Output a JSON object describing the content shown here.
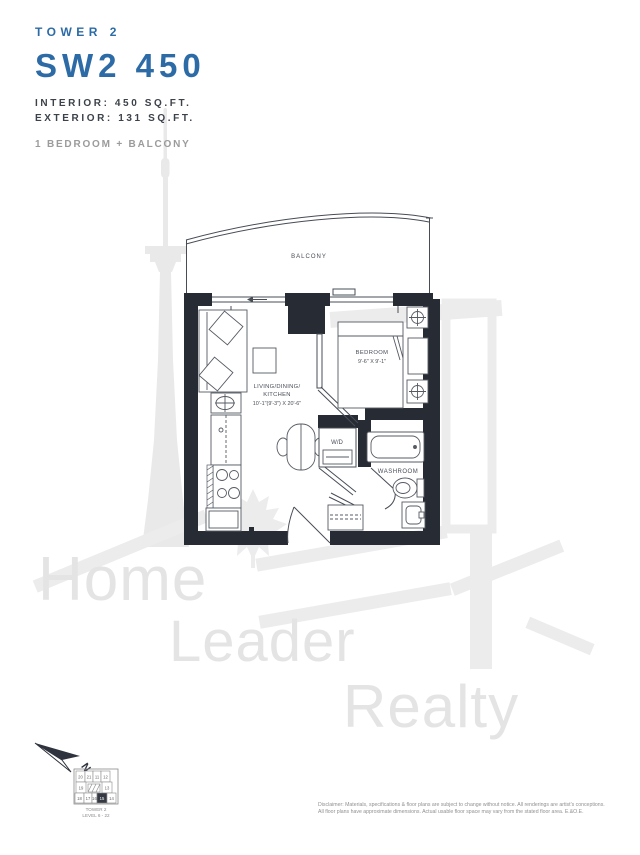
{
  "header": {
    "tower": "TOWER 2",
    "unit_name": "SW2 450",
    "interior": "INTERIOR: 450 SQ.FT.",
    "exterior": "EXTERIOR: 131 SQ.FT.",
    "configuration": "1 BEDROOM + BALCONY"
  },
  "colors": {
    "accent_blue": "#2c6ba6",
    "wall_dark": "#262b34",
    "line_gray": "#474c55",
    "watermark_gray": "#e4e4e4"
  },
  "floorplan": {
    "labels": {
      "balcony": "BALCONY",
      "bedroom": "BEDROOM",
      "bedroom_dims": "9'-6\" X 9'-1\"",
      "living_line1": "LIVING/DINING/",
      "living_line2": "KITCHEN",
      "living_dims": "10'-1\"(9'-3\") X 20'-6\"",
      "wd": "W/D",
      "washroom": "WASHROOM"
    }
  },
  "keyplan": {
    "units": [
      "20",
      "21",
      "11",
      "12",
      "19",
      "13",
      "18",
      "17",
      "16",
      "15",
      "14"
    ],
    "highlighted_unit": "15",
    "tower": "TOWER 2",
    "levels": "LEVEL 6 - 22"
  },
  "compass": {
    "north": "N"
  },
  "watermark": {
    "words": [
      "Home",
      "Leader",
      "Realty"
    ]
  },
  "disclaimer": {
    "line1": "Disclaimer: Materials, specifications & floor plans are subject to change without notice. All renderings are artist's conceptions.",
    "line2": "All floor plans have approximate dimensions. Actual usable floor space may vary from the stated floor area. E.&O.E."
  }
}
